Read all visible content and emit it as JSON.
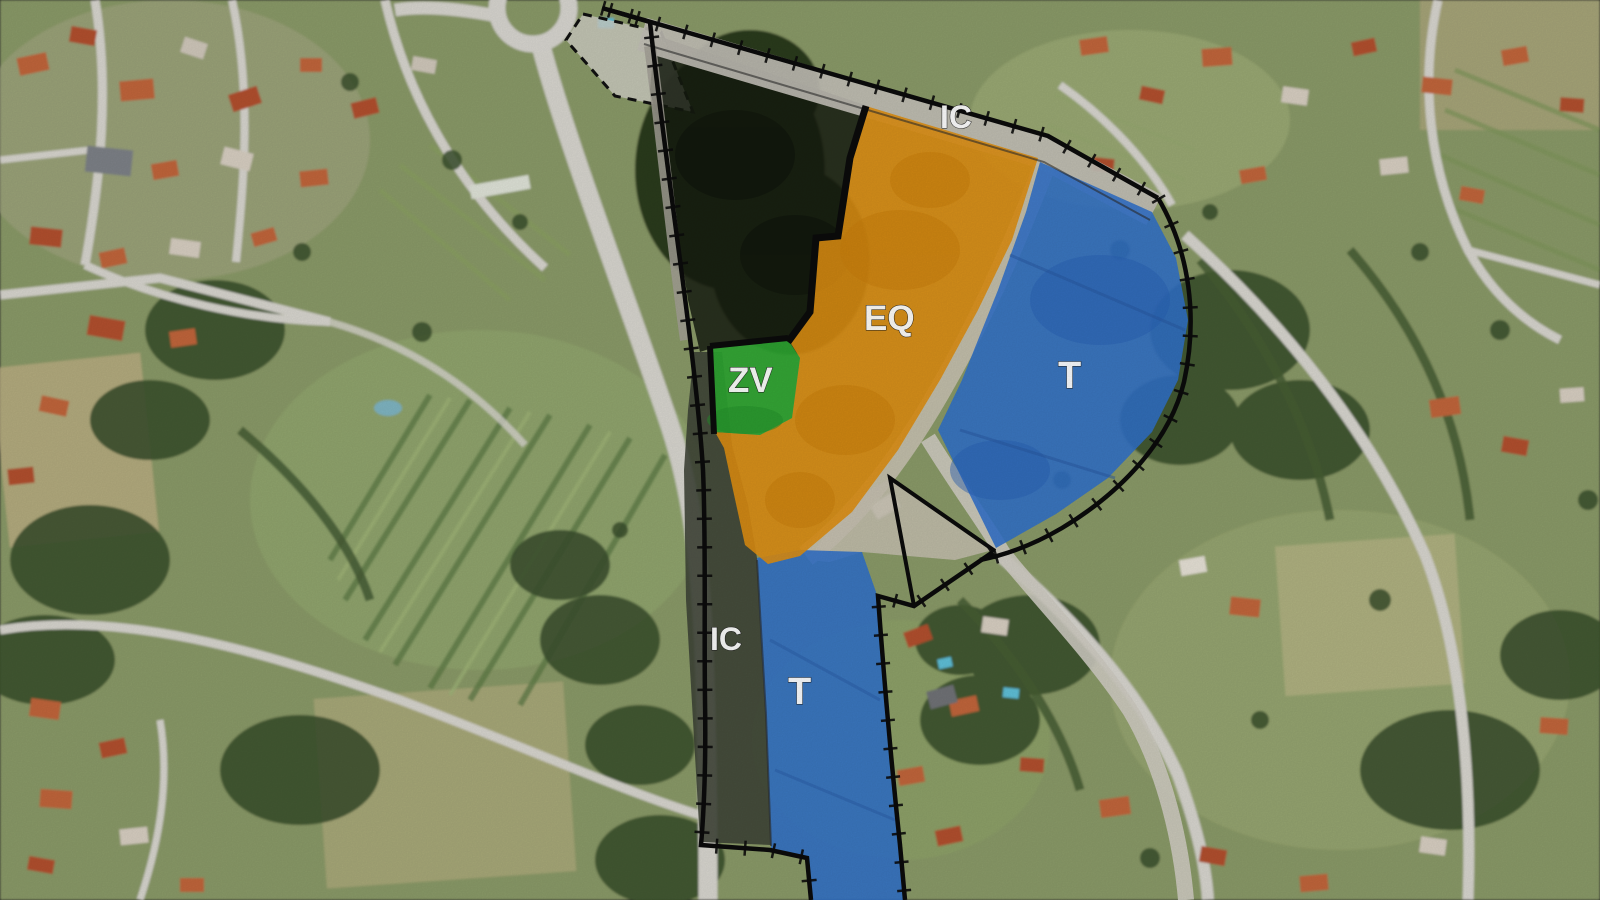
{
  "zones": {
    "ic_top": {
      "label": "IC",
      "color": "#c2bfb6"
    },
    "eq": {
      "label": "EQ",
      "color": "#de8e12"
    },
    "zv": {
      "label": "ZV",
      "color": "#2ca631"
    },
    "t_upper": {
      "label": "T",
      "color": "#2f6fc9"
    },
    "ic_lower": {
      "label": "IC",
      "color": "#3b4134"
    },
    "t_lower": {
      "label": "T",
      "color": "#2f6fc9"
    }
  },
  "colors": {
    "boundary": "#0b0b0b",
    "road_strip": "#c7c1b0",
    "dark_zone": "#151b0f",
    "label_text": "#ffffff"
  }
}
